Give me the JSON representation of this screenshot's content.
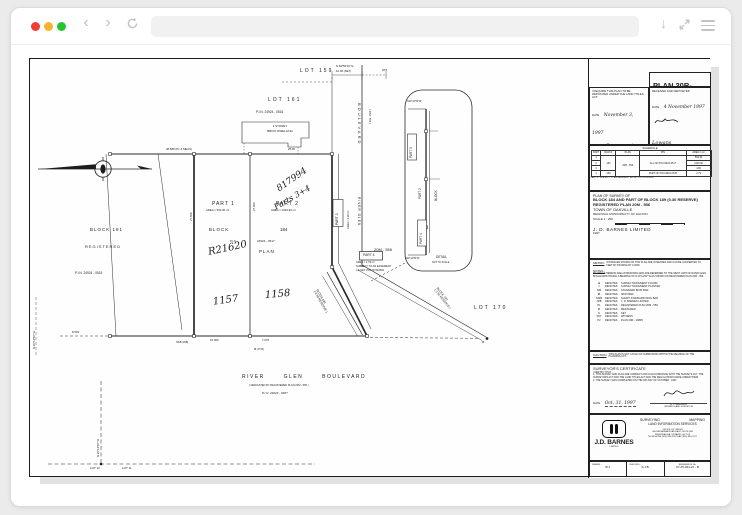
{
  "browser": {
    "traffic": {
      "close": "#f03e34",
      "minimize": "#f7b32b",
      "zoom": "#23c532"
    },
    "icons": {
      "back": "‹",
      "forward": "›",
      "download": "↓"
    },
    "url_value": ""
  },
  "sheet": {
    "map": {
      "lot159": "LOT 159",
      "bearTop": "N 69°50'10\" E",
      "dimTop": "10.06 (SET)",
      "wit": "WIT",
      "lot161": "LOT 161",
      "pin0516": "P.I.N. 24924 - 0516",
      "dwelling1": "1 STOREY",
      "dwelling2": "BRICK DWELLING",
      "part1": "PART 1",
      "part1area": "AREA = 552.90 m²",
      "part2": "PART 2",
      "part2area": "AREA = 1046.90 m²",
      "part3": "PART 3",
      "part3area": "AREA = 4.90 m²",
      "part4": "PART 4",
      "part4a": "AREA = 2.79 m²",
      "part4b": "SUBJECT TO AN EASEMENT",
      "part4c": "AS SET OUT IN 504502",
      "block181": "BLOCK 181",
      "registered": "REGISTERED",
      "pin0515": "P.I.N. 24924 - 0515",
      "blockWord": "BLOCK",
      "num184": "184",
      "pinWord": "P.I.N.",
      "pin0517": "24924 - 0517",
      "planWord": "PLAN",
      "hwPlan": "R21620",
      "hw1157": "1157",
      "hw1158": "1158",
      "hw817994": "817994",
      "hwParts": "Parts 3+4",
      "m20m556": "20M - 556",
      "river": "RIVER GLEN BOULEVARD",
      "dedicated": "( DEDICATED BY REGISTERED PLAN 20M - 556 )",
      "pin0487": "P.I.N. 24924 - 0487",
      "lot170": "LOT 170",
      "block190": "BLOCK 190",
      "res190": "( 0.30 RESERVE )",
      "block189": "BLOCK 189",
      "res189": "( 0.30 RESERVE )",
      "lot12": "LOT 12",
      "lot11": "LOT 11",
      "bearLeft": "N 20°12'50\" W",
      "bearBottom": "N 20°12'50\" W",
      "vBlvd": "BOULEVARD",
      "v20m": "( 20M - 556 )",
      "vRiver": "RIVER GLEN",
      "dim38": "38.688 (P1 & MEAS)",
      "dim25": "25.00",
      "dim15": "15.000",
      "dim7": "7.675",
      "dim8": "8.503",
      "dim27a": "27.509",
      "dim27b": "27.609",
      "ssib": "SSIB (JDB)",
      "ib1743": "IB (1743)",
      "ibDot": "IB"
    },
    "detail": {
      "bearTop": "N20°12'50\"W",
      "part3": "PART 3",
      "part2": "PART 2",
      "blockWord": "BLOCK",
      "part4": "PART 4",
      "bearBot": "N20°12'50\"W",
      "t1": "DETAIL",
      "t2": "NOT TO SCALE"
    },
    "tb": {
      "planPrefix": "PLAN 20R-",
      "planNoHw": "12623",
      "dep": {
        "text": "I REQUIRE THIS PLAN TO BE DEPOSITED UNDER THE LAND TITLES ACT.",
        "dateLbl": "DATE",
        "dateVal": "November 3, 1997",
        "name": "B. J. BALABAN",
        "role": "ONTARIO LAND SURVEYOR"
      },
      "rec": {
        "title": "RECEIVED AND DEPOSITED",
        "dateLbl": "DATE",
        "dateVal": "4 November 1997",
        "sig": "Lowans",
        "r1": "LAND REGISTRAR FOR THE",
        "r2": "LAND TITLES DIVISION OF",
        "r3": "HALTON  ( No. 20 )"
      },
      "schedule": {
        "title": "SCHEDULE",
        "h": [
          "PART",
          "BLOCK",
          "PLAN",
          "PIN",
          "AREA in m²"
        ],
        "r1": [
          "1",
          "184",
          "20M - 556",
          "ALL OF PIN 24924-0517",
          "552.90"
        ],
        "r2": [
          "2",
          "1046.90"
        ],
        "r3": [
          "3",
          "4.90"
        ],
        "r4": [
          "4",
          "189",
          "PART OF PIN 24924-0515",
          "2.79"
        ],
        "note": "PART 4 - SUBJECT TO AN EASEMENT AS SET OUT IN 504502"
      },
      "title": {
        "t1": "PLAN OF SURVEY OF",
        "t2": "BLOCK 184 AND PART OF BLOCK 189 (0.30 RESERVE)",
        "t3": "REGISTERED PLAN 20M - 556",
        "t4": "TOWN OF OAKVILLE",
        "t5": "REGIONAL MUNICIPALITY OF HALTON",
        "scale": "SCALE  1 : 250",
        "firm": "J. D.  BARNES  LIMITED",
        "year": "1997"
      },
      "metricLbl": "METRIC",
      "metricTxt": "DISTANCES SHOWN ON THIS PLAN ARE IN METRES AND CAN BE CONVERTED TO FEET BY DIVIDING BY 0.3048",
      "notesLbl": "NOTES :",
      "notesTxt": "BEARINGS HEREON ARE ASTRONOMIC AND ARE REFERRED TO THE WEST LIMIT OF RIVER GLEN BOULEVARD HAVING A BEARING OF N 20°12'50\" W AS SHOWN ON REGISTERED PLAN 20M - 556.",
      "legend": [
        [
          "■",
          "DENOTES",
          "SURVEY MONUMENT FOUND"
        ],
        [
          "□",
          "DENOTES",
          "SURVEY MONUMENT PLANTED"
        ],
        [
          "SIB",
          "DENOTES",
          "STANDARD IRON BAR"
        ],
        [
          "IB",
          "DENOTES",
          "IRON BAR"
        ],
        [
          "SSIB",
          "DENOTES",
          "SHORT STANDARD IRON BAR"
        ],
        [
          "JDB",
          "DENOTES",
          "J. D. BARNES LIMITED"
        ],
        [
          "P1",
          "DENOTES",
          "REGISTERED PLAN 20M - 556"
        ],
        [
          "M",
          "DENOTES",
          "MEASURED"
        ],
        [
          "S",
          "DENOTES",
          "SET"
        ],
        [
          "WIT",
          "DENOTES",
          "WITNESS"
        ],
        [
          "P2",
          "DENOTES",
          "PLAN 20R - 10835"
        ]
      ],
      "cautionLbl": "CAUTION",
      "cautionTxt": "THIS PLAN IS NOT A PLAN OF SUBDIVISION WITHIN THE MEANING OF THE PLANNING ACT.",
      "cert": {
        "t": "SURVEYOR'S CERTIFICATE",
        "intro": "I CERTIFY THAT :",
        "i1": "1. THIS SURVEY AND PLAN ARE CORRECT AND IN ACCORDANCE WITH THE SURVEYS ACT, THE SURVEYORS ACT AND THE LAND TITLES ACT AND THE REGULATIONS MADE UNDER THEM.",
        "i2": "2. THE SURVEY WAS COMPLETED ON THE 20th DAY OF OCTOBER , 1997.",
        "dateLbl": "DATE",
        "dateVal": "Oct. 31, 1997",
        "name": "B. J. BALABAN",
        "role": "ONTARIO LAND SURVEYOR"
      },
      "firmBlock": {
        "logo": "J.D. BARNES",
        "logoSub": "LIMITED",
        "s1": "SURVEYING",
        "s2": "MAPPING",
        "s3": "LAND INFORMATION SERVICES",
        "o1": "OFFICE OF ORIGIN",
        "o2": "400 BRITANNIA ROAD EAST, SUITE 908",
        "o3": "MISSISSAUGA, ONTARIO  L4Z 1X9",
        "o4": "TELEPHONE (905) 890-2307   FAX (905) 890-2377"
      },
      "footer": {
        "dLbl": "DRAWN :",
        "dVal": "W.J.",
        "cLbl": "CHECKED :",
        "cVal": "S.J.B.",
        "rLbl": "REFERENCE No.",
        "rVal": "97-25-464-21 - B"
      }
    }
  }
}
